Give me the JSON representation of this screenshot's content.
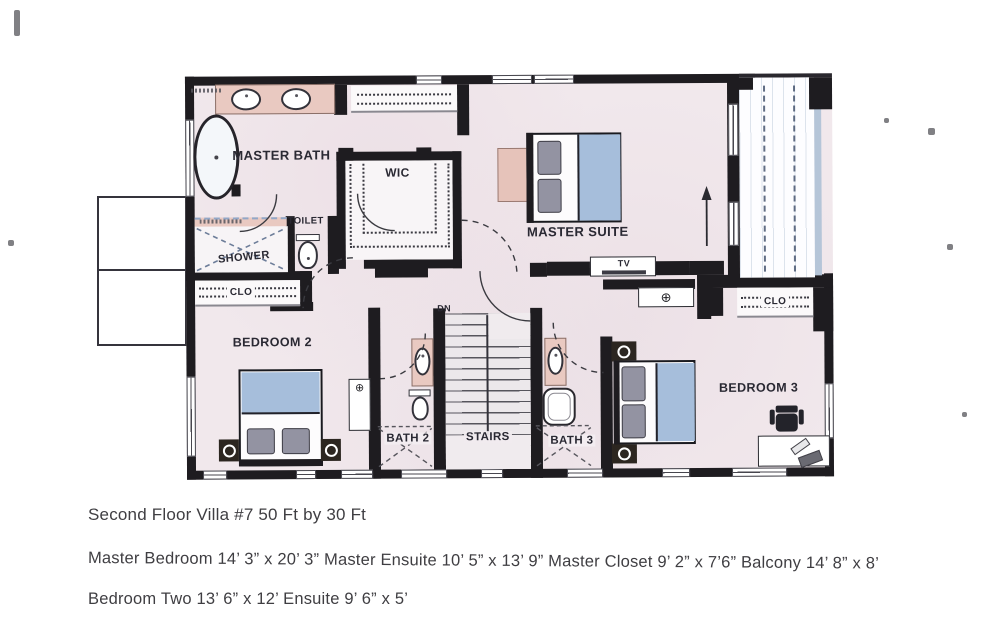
{
  "rooms": {
    "master_bath": "MASTER BATH",
    "wic": "WIC",
    "toilet": "TOILET",
    "shower": "SHOWER",
    "master_suite": "MASTER SUITE",
    "clo_left": "CLO",
    "clo_right": "CLO",
    "bedroom2": "BEDROOM 2",
    "bath2": "BATH 2",
    "stairs": "STAIRS",
    "bath3": "BATH 3",
    "bedroom3": "BEDROOM 3"
  },
  "annotations": {
    "tv": "TV",
    "dn": "DN"
  },
  "icons": {
    "crossed_circle": "⊕"
  },
  "captions": {
    "line1": "Second Floor Villa #7 50 Ft by 30 Ft",
    "line2": "Master Bedroom 14’ 3” x 20’ 3” Master Ensuite 10’ 5” x 13’ 9” Master Closet 9’ 2” x 7’6” Balcony 14’ 8” x 8’",
    "line3": "Bedroom Two 13’ 6” x 12’ Ensuite 9’ 6” x 5’"
  },
  "colors": {
    "wall": "#1e1c20",
    "floor": "#f1e8ec",
    "vanity_pink": "#e9c9c1",
    "blanket_blue": "#a6bedb",
    "pillow_gray": "#9393a2",
    "balcony_rail": "#b5c5d8",
    "detail_line": "#56555c"
  }
}
